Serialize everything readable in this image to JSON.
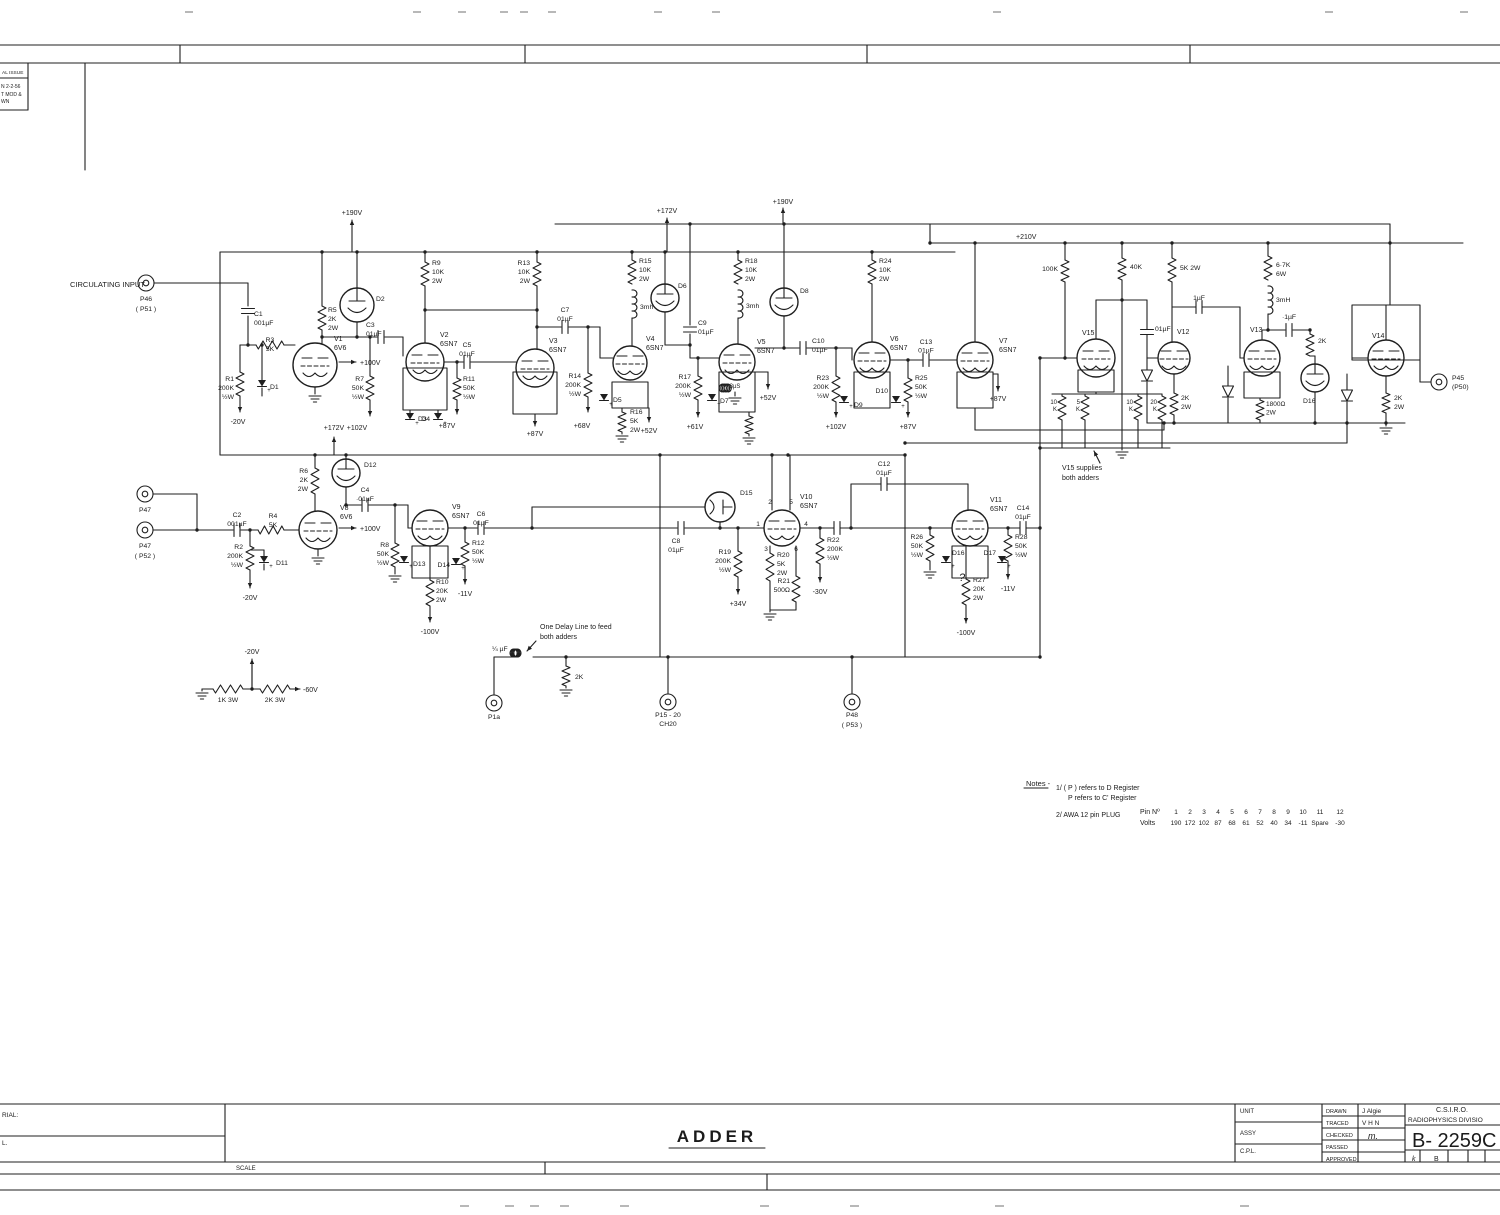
{
  "sheet": {
    "title": "ADDER",
    "scale_label": "SCALE",
    "material_label": "RIAL:",
    "material_label2": "L.",
    "revision_box": {
      "header": "AL ISSUE",
      "rows": [
        "N 2-2-56",
        "T MOD &",
        "WN"
      ]
    },
    "title_block": {
      "unit_label": "UNIT",
      "assy_label": "ASSY",
      "cpl_label": "C.P.L.",
      "drawn_label": "DRAWN",
      "drawn_value": "J Algie",
      "traced_label": "TRACED",
      "traced_value": "V H N",
      "checked_label": "CHECKED",
      "checked_value": "m.",
      "passed_label": "PASSED",
      "approved_label": "APPROVED",
      "org_line1": "C.S.I.R.O.",
      "org_line2": "RADIOPHYSICS DIVISIO",
      "drawing_number": "B- 2259C",
      "zone_letters": [
        "k",
        "B"
      ]
    },
    "notes": {
      "header": "Notes -",
      "n1a": "1/  ( P   )  refers  to  D  Register",
      "n1b": "P       refers  to  C' Register",
      "n2": "2/   AWA  12 pin PLUG",
      "pin_label": "Pin Nº",
      "volts_label": "Volts",
      "pins": [
        "1",
        "2",
        "3",
        "4",
        "5",
        "6",
        "7",
        "8",
        "9",
        "10",
        "11",
        "12"
      ],
      "volts": [
        "190",
        "172",
        "102",
        "87",
        "68",
        "61",
        "52",
        "40",
        "34",
        "-11",
        "Spare",
        "-30"
      ]
    },
    "annotations": {
      "circulating_input": "CIRCULATING INPUT",
      "v15_note1": "V15 supplies",
      "v15_note2": "both adders",
      "delay_note1": "One Delay Line to feed",
      "delay_note2": "both adders"
    }
  },
  "labels": {
    "P46": [
      "P46",
      "( P51 )"
    ],
    "P47a": [
      "P47"
    ],
    "P47b": [
      "P47",
      "( P52 )"
    ],
    "P1a": [
      "P1a"
    ],
    "P15": [
      "P15 - 20",
      "CH20"
    ],
    "P48": [
      "P48",
      "( P53 )"
    ],
    "P45": [
      "P45",
      "(P50)"
    ],
    "V1": [
      "V1",
      "6V6"
    ],
    "V2": [
      "V2",
      "6SN7"
    ],
    "V3": [
      "V3",
      "6SN7"
    ],
    "V4": [
      "V4",
      "6SN7"
    ],
    "V5": [
      "V5",
      "6SN7"
    ],
    "V6": [
      "V6",
      "6SN7"
    ],
    "V7": [
      "V7",
      "6SN7"
    ],
    "V8": [
      "V8",
      "6V6"
    ],
    "V9": [
      "V9",
      "6SN7"
    ],
    "V10": [
      "V10",
      "6SN7"
    ],
    "V11": [
      "V11",
      "6SN7"
    ],
    "V12": [
      "V12"
    ],
    "V13": [
      "V13"
    ],
    "V14": [
      "V14"
    ],
    "V15": [
      "V15"
    ],
    "v10_pins": [
      "2",
      "5",
      "1",
      "4",
      "3",
      "6"
    ],
    "D1": "D1",
    "D2": "D2",
    "D3": "D3",
    "D4": "D4",
    "D5": "D5",
    "D6": "D6",
    "D7": "D7",
    "D8": "D8",
    "D9": "D9",
    "D10": "D10",
    "D11": "D11",
    "D12": "D12",
    "D13": "D13",
    "D14": "D14",
    "D15": "D15",
    "D16t": "D16",
    "D16b": "D16",
    "D17": "D17",
    "qmark": "?",
    "plus": "+",
    "R1": [
      "R1",
      "200K",
      "½W"
    ],
    "R2": [
      "R2",
      "200K",
      "½W"
    ],
    "R3": [
      "R3",
      "5K"
    ],
    "R4": [
      "R4",
      "5K"
    ],
    "R5": [
      "R5",
      "2K",
      "2W"
    ],
    "R6": [
      "R6",
      "2K",
      "2W"
    ],
    "R7": [
      "R7",
      "50K",
      "½W"
    ],
    "R8": [
      "R8",
      "50K",
      "½W"
    ],
    "R9": [
      "R9",
      "10K",
      "2W"
    ],
    "R10": [
      "R10",
      "20K",
      "2W"
    ],
    "R11": [
      "R11",
      "50K",
      "½W"
    ],
    "R12": [
      "R12",
      "50K",
      "½W"
    ],
    "R13": [
      "R13",
      "10K",
      "2W"
    ],
    "R14": [
      "R14",
      "200K",
      "½W"
    ],
    "R15": [
      "R15",
      "10K",
      "2W"
    ],
    "R16": [
      "R16",
      "5K",
      "2W"
    ],
    "R17": [
      "R17",
      "200K",
      "½W"
    ],
    "R18": [
      "R18",
      "10K",
      "2W"
    ],
    "R19": [
      "R19",
      "200K",
      "½W"
    ],
    "R20": [
      "R20",
      "5K",
      "2W"
    ],
    "R21": [
      "R21",
      "500Ω"
    ],
    "R22": [
      "R22",
      "200K",
      "½W"
    ],
    "R23": [
      "R23",
      "200K",
      "½W"
    ],
    "R24": [
      "R24",
      "10K",
      "2W"
    ],
    "R25": [
      "R25",
      "50K",
      "½W"
    ],
    "R26": [
      "R26",
      "50K",
      "½W"
    ],
    "R27": [
      "R27",
      "20K",
      "2W"
    ],
    "R28": [
      "R28",
      "50K",
      "½W"
    ],
    "res_100K": "100K",
    "res_40K": "40K",
    "res_5K2W": "5K 2W",
    "res_67K": [
      "6·7K",
      "6W"
    ],
    "res_2K_v13": "2K",
    "res_1800": [
      "1800Ω",
      "2W"
    ],
    "res_2K2W_v12": [
      "2K",
      "2W"
    ],
    "res_2K2W_v14": [
      "2K",
      "2W"
    ],
    "res_10K_a": [
      "10",
      "K"
    ],
    "res_5K_a": [
      "5",
      "K"
    ],
    "res_10K_b": [
      "10",
      "K"
    ],
    "res_20K_b": [
      "20",
      "K"
    ],
    "res_1K3W": "1K 3W",
    "res_2K3W": "2K 3W",
    "res_2K_dl": "2K",
    "C1": [
      "C1",
      "001µF"
    ],
    "C2": [
      "C2",
      "001µF"
    ],
    "C3": [
      "C3",
      "01µF"
    ],
    "C4": [
      "C4",
      "·01µF"
    ],
    "C5": [
      "C5",
      "01µF"
    ],
    "C6": [
      "C6",
      "01µF"
    ],
    "C7": [
      "C7",
      "01µF"
    ],
    "C8": [
      "C8",
      "01µF"
    ],
    "C9": [
      "C9",
      "01µF"
    ],
    "C10": [
      "C10",
      "01µF"
    ],
    "C12": [
      "C12",
      "01µF"
    ],
    "C13": [
      "C13",
      "01µF"
    ],
    "C14": [
      "C14",
      "01µF"
    ],
    "cap_1uF": "1µF",
    "cap_p1uF": "·1µF",
    "cap_01uF": "01µF",
    "cap_quarter": "¼ µF",
    "L1": "3mh",
    "L2": "3mh",
    "L3": "3mH",
    "L4": "3µS",
    "vp190a": "+190V",
    "vp190b": "+190V",
    "vp172a": "+172V",
    "vp172b": "+172V",
    "vp210": "+210V",
    "vp100a": "+100V",
    "vp100b": "+100V",
    "vp102a": "+102V",
    "vp102b": "+102V",
    "vp87a": "+87V",
    "vp87b": "+87V",
    "vp87c": "+87V",
    "vp87d": "+87V",
    "vp68": "+68V",
    "vp61": "+61V",
    "vp52a": "+52V",
    "vp52b": "+52V",
    "vp34": "+34V",
    "vm30": "-30V",
    "vm20a": "-20V",
    "vm20b": "-20V",
    "vm20c": "-20V",
    "vm60": "-60V",
    "vm100a": "-100V",
    "vm100b": "-100V",
    "vm11a": "-11V",
    "vm11b": "-11V"
  }
}
